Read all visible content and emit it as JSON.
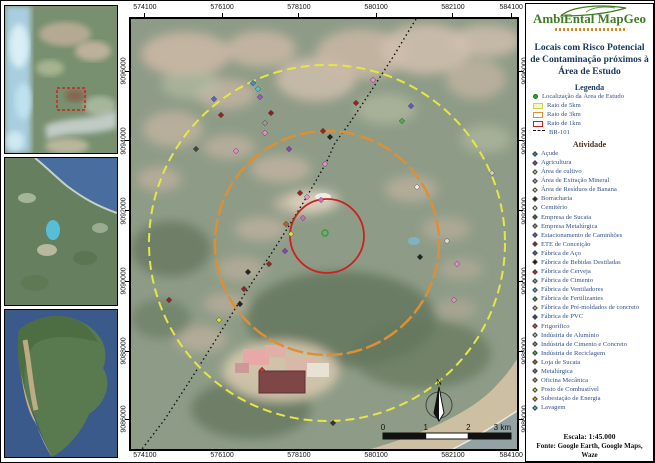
{
  "colors": {
    "accent_green": "#3e7d23",
    "title_navy": "#17365d",
    "radius_5km": "#e6e645",
    "radius_3km": "#dd8f33",
    "radius_1km": "#cc2020",
    "study_green": "#2fa32f"
  },
  "frame": {
    "top_labels": [
      "574100",
      "576100",
      "578100",
      "580100",
      "582100",
      "584100"
    ],
    "bottom_labels": [
      "574100",
      "576100",
      "578100",
      "580100",
      "582100",
      "584100"
    ],
    "left_labels": [
      "9096000",
      "9094000",
      "9092000",
      "9090000",
      "9088000",
      "9086000"
    ],
    "right_labels": [
      "9096000",
      "9094000",
      "9092000",
      "9090000",
      "9088000",
      "9086000"
    ]
  },
  "panel": {
    "logo_text": "AmbiEntal MapGeo",
    "title": "Locais com Risco Potencial de Contaminação próximos à Área de Estudo",
    "legend": {
      "heading": "Legenda",
      "items": [
        {
          "label": "Localização da Área de Estudo",
          "symbol": "dot",
          "color": "#2fa32f",
          "border": "#1d6e1d"
        },
        {
          "label": "Raio de 5km",
          "symbol": "rect",
          "color": "#f8f8c0",
          "border": "#cfcf55"
        },
        {
          "label": "Raio de 3km",
          "symbol": "rect",
          "color": "#ffffff",
          "border": "#dd8f33"
        },
        {
          "label": "Raio de 1km",
          "symbol": "rect",
          "color": "#ffffff",
          "border": "#cc2020"
        },
        {
          "label": "BR-101",
          "symbol": "dash",
          "color": "#111111",
          "border": "#111111"
        }
      ]
    },
    "activities": {
      "heading": "Atividade",
      "items": [
        {
          "label": "Açude",
          "color": "#2288cc"
        },
        {
          "label": "Agricultura",
          "color": "#9933cc"
        },
        {
          "label": "Área de cultivo",
          "color": "#aaddaa"
        },
        {
          "label": "Área de Extração Mineral",
          "color": "#aaaaaa"
        },
        {
          "label": "Área de Resíduos de Banana",
          "color": "#ddddaa"
        },
        {
          "label": "Borracharia",
          "color": "#222222"
        },
        {
          "label": "Cemitério",
          "color": "#f5f5f5"
        },
        {
          "label": "Empresa de Sucata",
          "color": "#555555"
        },
        {
          "label": "Empresa Metalúrgica",
          "color": "#8899aa"
        },
        {
          "label": "Estacionamento de Caminhões",
          "color": "#7755cc"
        },
        {
          "label": "ETE de Conceição",
          "color": "#992222"
        },
        {
          "label": "Fábrica de Aço",
          "color": "#4466bb"
        },
        {
          "label": "Fábrica de Bebidas Destiladas",
          "color": "#111111"
        },
        {
          "label": "Fábrica de Cerveja",
          "color": "#cc2222"
        },
        {
          "label": "Fábrica de Cimento",
          "color": "#999999"
        },
        {
          "label": "Fábrica de Ventiladores",
          "color": "#55aadd"
        },
        {
          "label": "Fábrica de Fertilizantes",
          "color": "#33aa55"
        },
        {
          "label": "Fábrica de Pré-moldados de concreto",
          "color": "#ccbb99"
        },
        {
          "label": "Fábrica de PVC",
          "color": "#334499"
        },
        {
          "label": "Frigorífico",
          "color": "#dd4444"
        },
        {
          "label": "Indústria de Alumínio",
          "color": "#bbbbcc"
        },
        {
          "label": "Indústria de Cimento e Concreto",
          "color": "#888888"
        },
        {
          "label": "Indústria de Reciclagem",
          "color": "#44bb44"
        },
        {
          "label": "Loja de Sucata",
          "color": "#996633"
        },
        {
          "label": "Metalúrgica",
          "color": "#667788"
        },
        {
          "label": "Oficina Mecânica",
          "color": "#ee8833"
        },
        {
          "label": "Posto de Combustível",
          "color": "#dddd33"
        },
        {
          "label": "Subestação de Energia",
          "color": "#ddaa22"
        },
        {
          "label": "Lavagem",
          "color": "#44cccc"
        }
      ]
    },
    "scale_text": "Escala: 1:45.000",
    "source_text": "Fonte: Google Earth, Google Maps, Waze"
  },
  "map": {
    "north_label": "N",
    "scalebar_labels": [
      "0",
      "1",
      "2",
      "3 km"
    ],
    "circles": [
      {
        "name": "raio-5km",
        "cx": 196,
        "cy": 224,
        "r": 178,
        "color": "#e6e645",
        "dash": "9 5",
        "w": 2
      },
      {
        "name": "raio-3km",
        "cx": 196,
        "cy": 224,
        "r": 112,
        "color": "#dd8f33",
        "dash": "16 4",
        "w": 2.5
      },
      {
        "name": "raio-1km",
        "cx": 196,
        "cy": 217,
        "r": 37,
        "color": "#cc2020",
        "dash": "",
        "w": 1.8
      }
    ],
    "study_point": {
      "x": 194,
      "y": 214,
      "color": "#2fa32f"
    },
    "road": {
      "color": "#111111",
      "points": "285,0 262,38 240,72 218,105 204,124 196,142 186,160 172,184 156,210 140,235 122,262 104,290 84,322 60,360 34,400 8,434"
    },
    "markers": [
      {
        "x": 122,
        "y": 64,
        "c": "#4488dd"
      },
      {
        "x": 127,
        "y": 70,
        "c": "#44cccc"
      },
      {
        "x": 129,
        "y": 78,
        "c": "#9955cc"
      },
      {
        "x": 140,
        "y": 94,
        "c": "#882222"
      },
      {
        "x": 134,
        "y": 104,
        "c": "#999999"
      },
      {
        "x": 134,
        "y": 114,
        "c": "#ee88cc"
      },
      {
        "x": 158,
        "y": 130,
        "c": "#8844bb"
      },
      {
        "x": 192,
        "y": 112,
        "c": "#992222"
      },
      {
        "x": 199,
        "y": 118,
        "c": "#222222"
      },
      {
        "x": 194,
        "y": 145,
        "c": "#ee88cc"
      },
      {
        "x": 169,
        "y": 174,
        "c": "#992222"
      },
      {
        "x": 176,
        "y": 178,
        "c": "#ee99cc"
      },
      {
        "x": 190,
        "y": 181,
        "c": "#dd66bb"
      },
      {
        "x": 172,
        "y": 199,
        "c": "#dd66bb"
      },
      {
        "x": 155,
        "y": 205,
        "c": "#aa6633"
      },
      {
        "x": 160,
        "y": 215,
        "c": "#dddd33"
      },
      {
        "x": 105,
        "y": 132,
        "c": "#ee88cc"
      },
      {
        "x": 90,
        "y": 96,
        "c": "#992222"
      },
      {
        "x": 83,
        "y": 80,
        "c": "#5566cc"
      },
      {
        "x": 65,
        "y": 130,
        "c": "#444444"
      },
      {
        "x": 154,
        "y": 232,
        "c": "#8844bb"
      },
      {
        "x": 138,
        "y": 245,
        "c": "#992222"
      },
      {
        "x": 117,
        "y": 253,
        "c": "#222222"
      },
      {
        "x": 113,
        "y": 270,
        "c": "#992222"
      },
      {
        "x": 109,
        "y": 285,
        "c": "#222222"
      },
      {
        "x": 38,
        "y": 281,
        "c": "#992222"
      },
      {
        "x": 88,
        "y": 301,
        "c": "#dddd33"
      },
      {
        "x": 131,
        "y": 351,
        "c": "#cc3333"
      },
      {
        "x": 242,
        "y": 61,
        "c": "#ee88cc"
      },
      {
        "x": 225,
        "y": 84,
        "c": "#992222"
      },
      {
        "x": 280,
        "y": 87,
        "c": "#6655cc"
      },
      {
        "x": 271,
        "y": 102,
        "c": "#55aa44"
      },
      {
        "x": 286,
        "y": 168,
        "c": "#eeeeee"
      },
      {
        "x": 316,
        "y": 222,
        "c": "#dddddd"
      },
      {
        "x": 289,
        "y": 238,
        "c": "#222222"
      },
      {
        "x": 326,
        "y": 245,
        "c": "#ee88cc"
      },
      {
        "x": 323,
        "y": 281,
        "c": "#ee88cc"
      },
      {
        "x": 361,
        "y": 154,
        "c": "#cccccc"
      },
      {
        "x": 202,
        "y": 404,
        "c": "#333333"
      }
    ]
  }
}
